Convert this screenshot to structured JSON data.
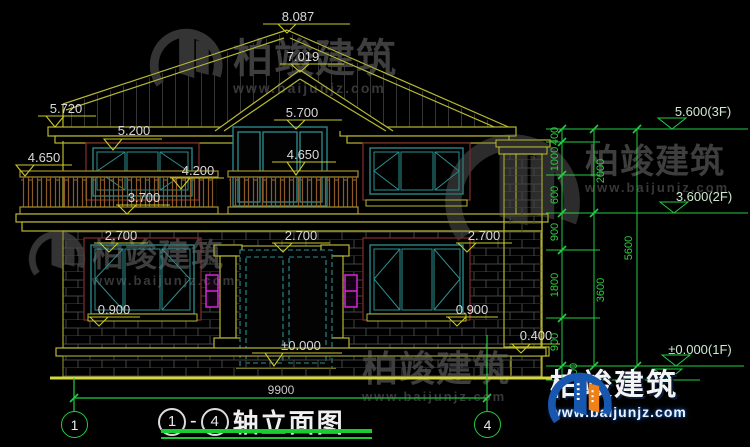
{
  "drawing": {
    "marks": {
      "ridge": "8.087",
      "gable_peak": "7.019",
      "eave_left": "5.720",
      "eave_soffit": "5.200",
      "terrace_rail_left": "4.650",
      "balcony_door_head": "5.700",
      "balcony_rail": "4.650",
      "window_head_2f": "4.200",
      "terrace_floor": "3.700",
      "window_head_1f_left": "2.700",
      "porch_beam": "2.700",
      "window_head_1f_right": "2.700",
      "sill_1f_left": "0.900",
      "sill_1f_right": "0.900",
      "ground_floor": "±0.000",
      "plinth_ledge": "0.400"
    },
    "floor_levels": {
      "f3": "5.600(3F)",
      "f2": "3.600(2F)",
      "f1": "±0.000(1F)"
    },
    "dim_chain": {
      "col1": [
        "400",
        "1000",
        "600",
        "900",
        "1800",
        "900",
        "300"
      ],
      "col2": [
        "2000",
        "3600"
      ],
      "col3": [
        "5600"
      ]
    },
    "overall_width": "9900",
    "axes": {
      "left": "1",
      "right": "4"
    },
    "title": {
      "axis_from": "1",
      "axis_to": "4",
      "dash": "-",
      "text": "轴立面图"
    }
  },
  "watermark": {
    "brand": "柏竣建筑",
    "site": "www.baijunjz.com"
  },
  "colors": {
    "line_yellow": "#b8b832",
    "line_green": "#22cc44",
    "frame_teal": "#2d8f8f",
    "surround_maroon": "#7a2a2a",
    "lamp_magenta": "#d428d4",
    "railing_brown": "#8a5a28",
    "brand_blue": "#1857b0",
    "brand_orange": "#f08018"
  }
}
